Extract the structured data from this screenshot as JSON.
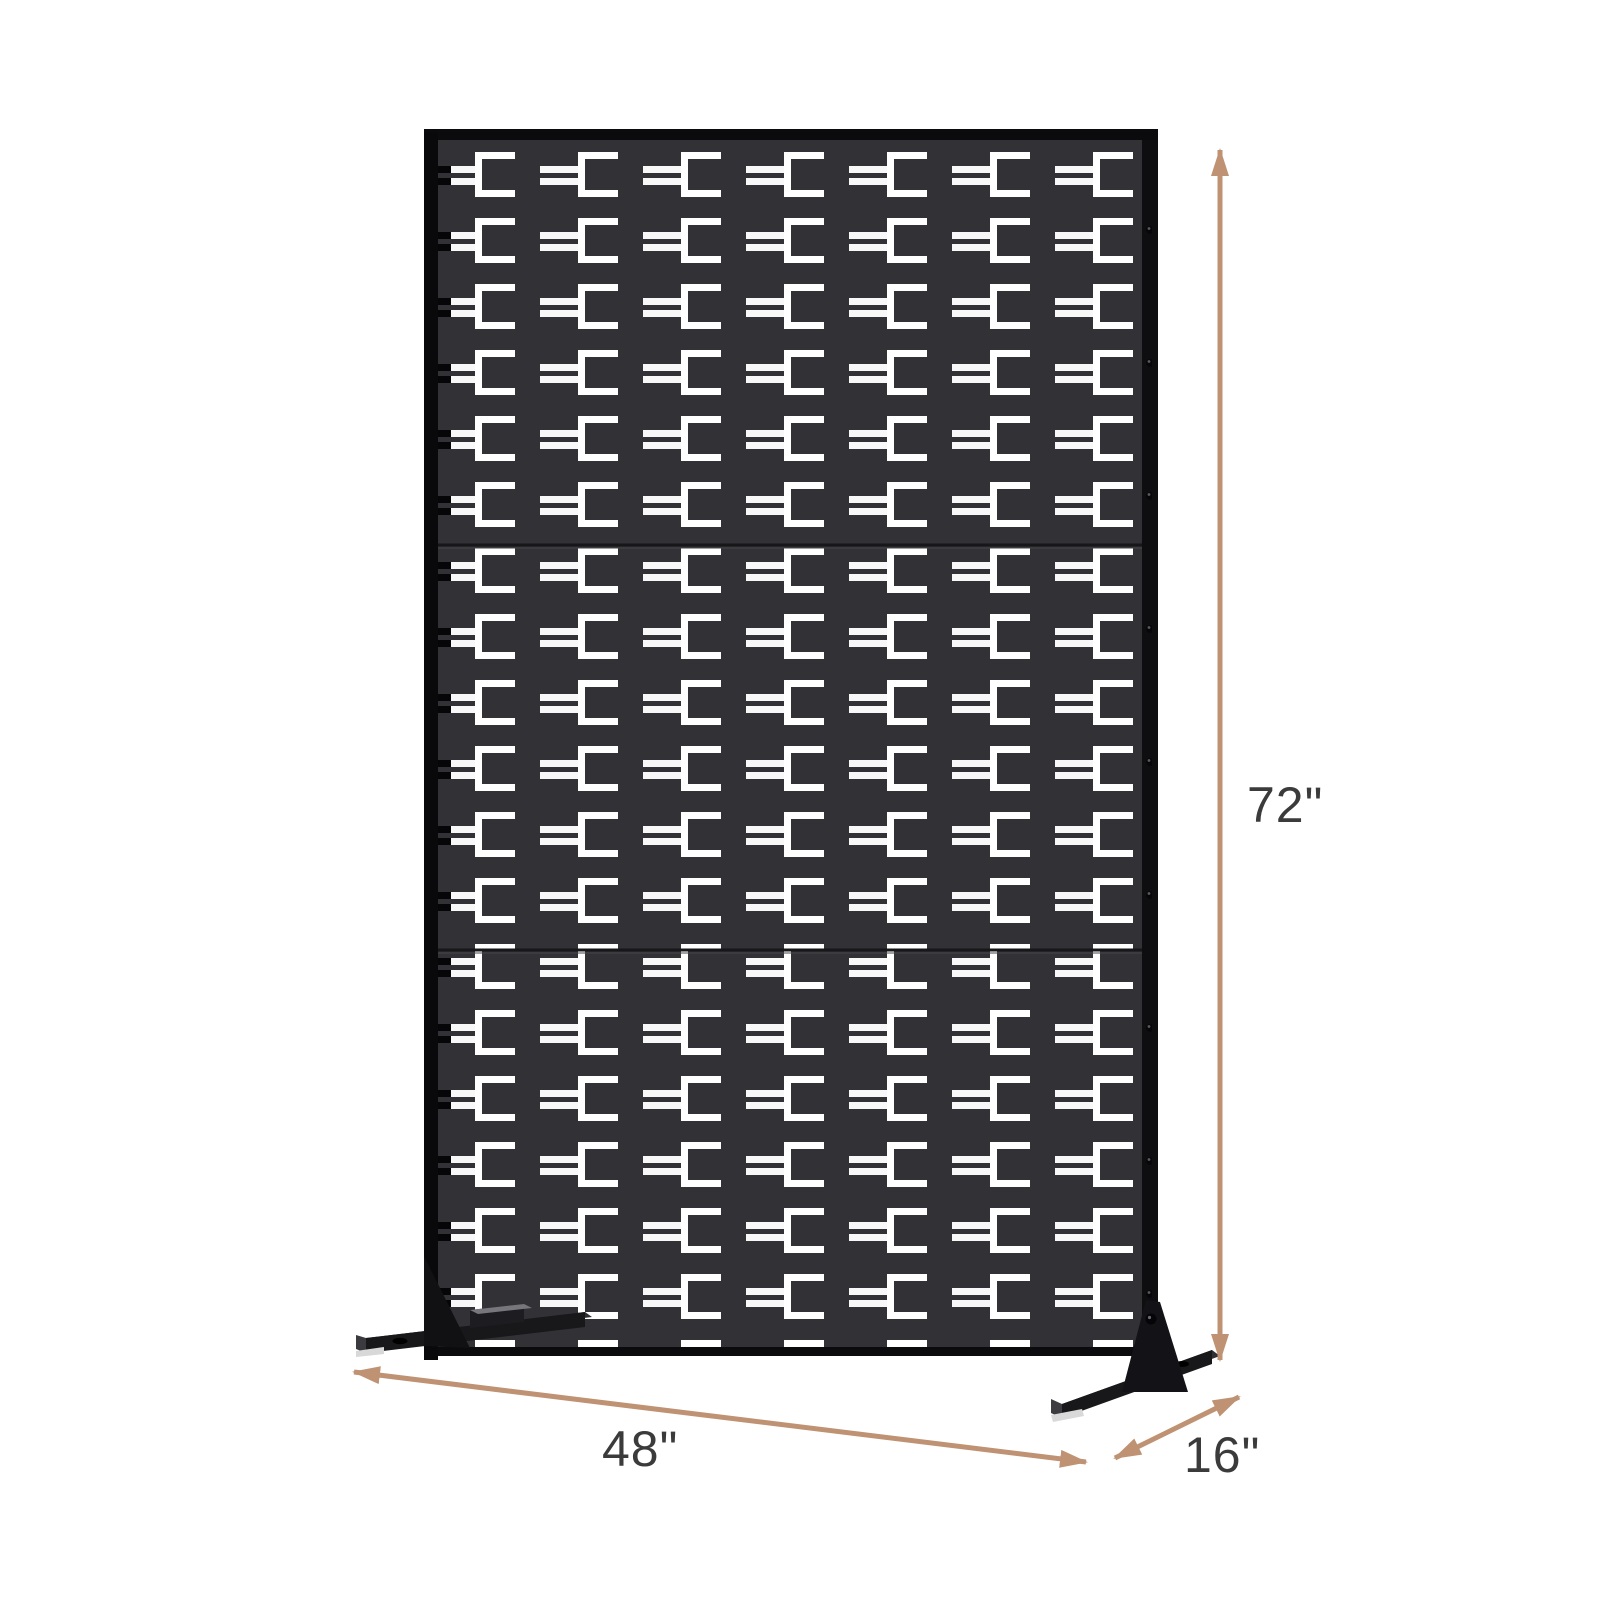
{
  "diagram": {
    "type": "product-dimension-diagram",
    "labels": {
      "height": "72\"",
      "width": "48\"",
      "depth": "16\""
    },
    "colors": {
      "dimension_arrow": "#BE9273",
      "label_text": "#3B3B3B",
      "panel_face": "#323236",
      "panel_frame": "#0D0D10",
      "cutout": "#FFFFFF",
      "background": "#FFFFFF"
    },
    "panel": {
      "sections": 3,
      "pattern_columns": 7,
      "pattern_rows": 18,
      "screw_holes": 9,
      "feet": 2
    }
  }
}
